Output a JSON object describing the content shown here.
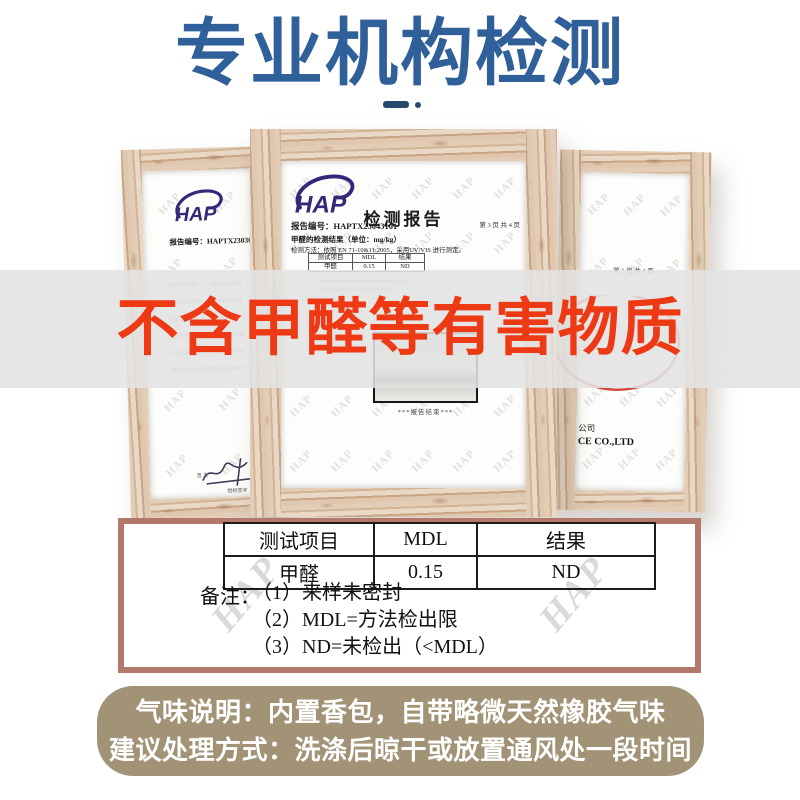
{
  "title": {
    "text": "专业机构检测"
  },
  "banner": {
    "text": "不含甲醛等有害物质"
  },
  "certificates": {
    "watermark": "HAP",
    "left": {
      "logo_text": "HAP",
      "report_no": "报告编号：HAPTX23030953",
      "sign_label": "签 发",
      "sign_sub": "授权签字"
    },
    "center": {
      "logo_text": "HAP",
      "title": "检测报告",
      "report_no": "报告编号：HAPTX23043101",
      "page_info": "第 3 页 共 4 页",
      "result_heading": "甲醛的检测结果（单位：mg/kg）",
      "method": "检测方法：依照 EN 71-10&11:2005，采用UV/VIS 进行测定。",
      "mini_table": {
        "headers": [
          "测试项目",
          "MDL",
          "结果"
        ],
        "row": [
          "甲醛",
          "0.15",
          "ND"
        ]
      },
      "photo_caption": "***报告结束***"
    },
    "right": {
      "page_info": "第 1 页 共 4 页",
      "company_cn": "公司",
      "company_en": "CE CO.,LTD"
    }
  },
  "result_box": {
    "table": {
      "headers": [
        "测试项目",
        "MDL",
        "结果"
      ],
      "rows": [
        [
          "甲醛",
          "0.15",
          "ND"
        ]
      ]
    },
    "note_label": "备注：",
    "notes": [
      "（1）来样未密封",
      "（2）MDL=方法检出限",
      "（3）ND=未检出（<MDL）"
    ]
  },
  "footer": {
    "line1": "气味说明：内置香包，自带略微天然橡胶气味",
    "line2": "建议处理方式：洗涤后晾干或放置通风处一段时间"
  },
  "colors": {
    "title_blue": "#30609a",
    "banner_red": "#ed3a14",
    "box_border": "#b3786b",
    "footer_khaki": "#a29377",
    "logo_indigo": "#332879",
    "wood_light": "#e3cdb6"
  }
}
